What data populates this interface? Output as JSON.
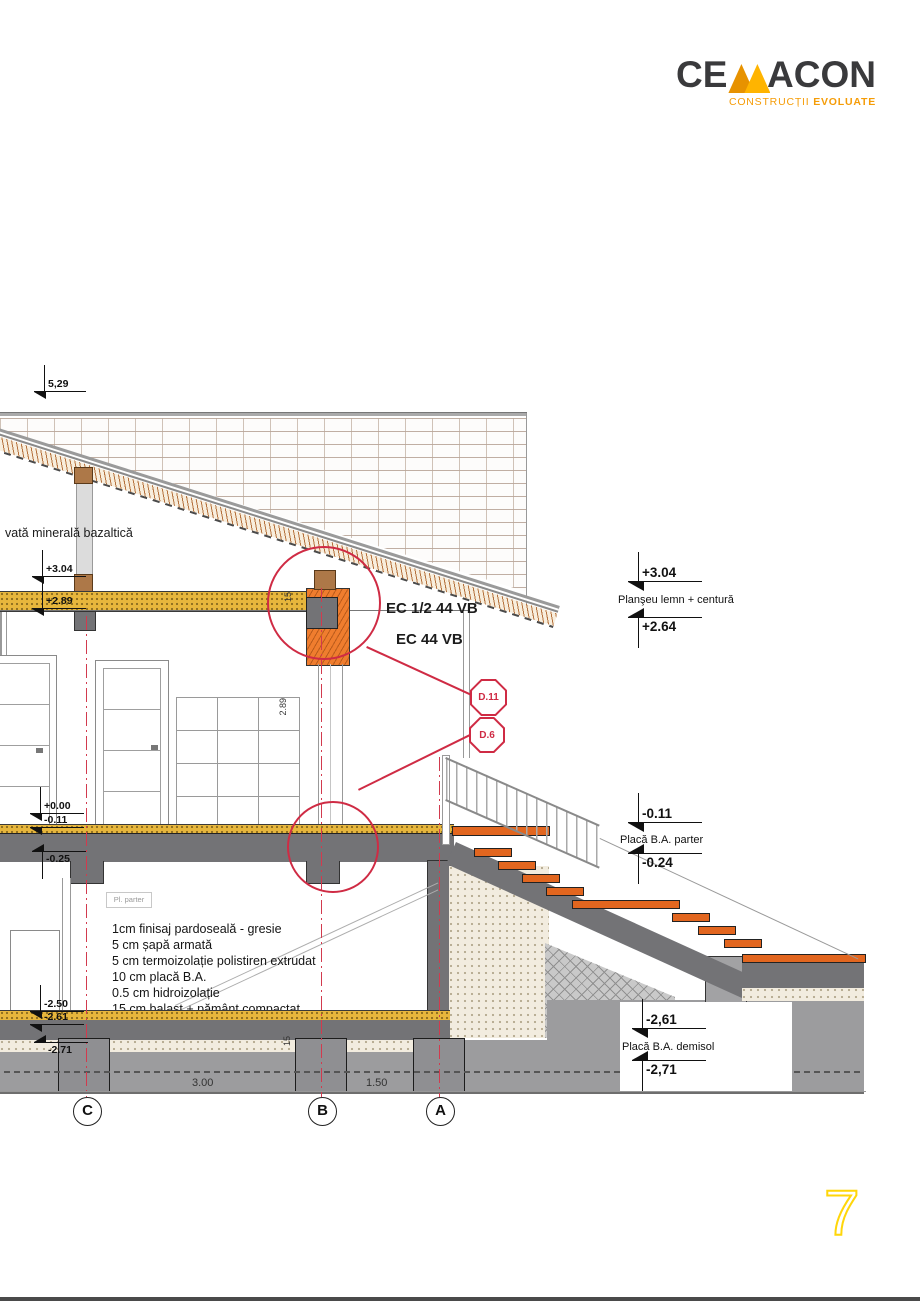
{
  "page": {
    "number": "7"
  },
  "logo": {
    "ce": "CE",
    "acon": "ACON",
    "tagline_regular": "CONSTRUCȚII ",
    "tagline_bold": "EVOLUATE"
  },
  "colors": {
    "red_accent": "#cf2b44",
    "masonry_orange": "#ef7d2e",
    "wood_yellow": "#e7b63c",
    "tread_orange": "#e2661f",
    "logo_orange": "#f59c07",
    "page_number_yellow": "#ffd60a"
  },
  "drawing": {
    "insulation_label": "vată minerală bazaltică",
    "ec_label_1": "EC 1/2 44 VB",
    "ec_label_2": "EC  44 VB",
    "detail_callouts": [
      {
        "id": "D.11"
      },
      {
        "id": "D.6"
      }
    ],
    "room_label": "Pl. parter",
    "floor_layers": [
      "1cm finisaj pardoseală - gresie",
      "5 cm șapă armată",
      "5 cm termoizolație polistiren extrudat",
      "10 cm placă B.A.",
      "0.5 cm hidroizolație",
      "15 cm balast + pământ compactat"
    ],
    "levels_left": [
      {
        "value": "5,29"
      },
      {
        "value": "+3.04"
      },
      {
        "value": "+2.89"
      },
      {
        "value": "+0.00"
      },
      {
        "value": "-0.11"
      },
      {
        "value": "-0.25"
      },
      {
        "value": "-2.50"
      },
      {
        "value": "-2.61"
      },
      {
        "value": "-2.71"
      }
    ],
    "levels_right": [
      {
        "value_top": "+3.04",
        "label": "Planşeu lemn + centură",
        "value_bottom": "+2.64"
      },
      {
        "value_top": "-0.11",
        "label": "Placă B.A. parter",
        "value_bottom": "-0.24"
      },
      {
        "value_top": "-2,61",
        "label": "Placă B.A. demisol",
        "value_bottom": "-2,71"
      }
    ],
    "axes": [
      {
        "label": "C"
      },
      {
        "label": "B"
      },
      {
        "label": "A"
      }
    ],
    "axis_dimensions": [
      "3.00",
      "1.50"
    ],
    "small_dimensions": {
      "attic_height": "2.89",
      "eaves_block": "15",
      "footing": "15"
    }
  }
}
